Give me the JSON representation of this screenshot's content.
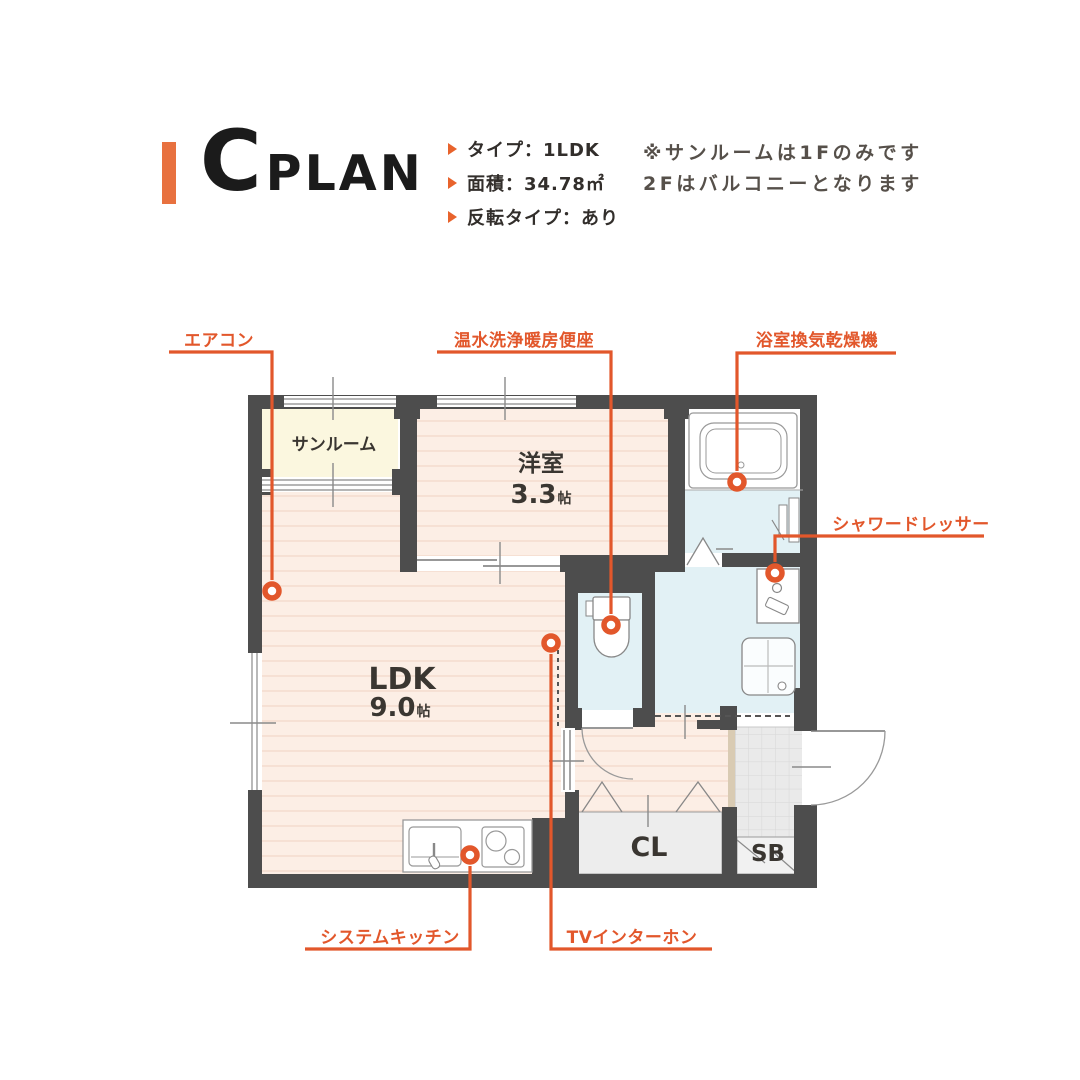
{
  "header": {
    "plan_letter": "C",
    "plan_word": "PLAN",
    "specs": [
      {
        "label": "タイプ：1LDK"
      },
      {
        "label": "面積：34.78㎡"
      },
      {
        "label": "反転タイプ：あり"
      }
    ],
    "note": {
      "line1": "※サンルームは1Fのみです",
      "line2": "2Fはバルコニーとなります"
    }
  },
  "plan": {
    "rooms": {
      "sunroom": "サンルーム",
      "western_room": {
        "name": "洋室",
        "size": "3.3",
        "unit": "帖"
      },
      "ldk": {
        "name": "LDK",
        "size": "9.0",
        "unit": "帖"
      },
      "closet": "CL",
      "shoe_box": "SB"
    },
    "callouts": {
      "air_conditioner": "エアコン",
      "washlet": "温水洗浄暖房便座",
      "bathroom_dryer": "浴室換気乾燥機",
      "shower_dresser": "シャワードレッサー",
      "system_kitchen": "システムキッチン",
      "tv_intercom": "TVインターホン"
    }
  },
  "colors": {
    "accent_orange": "#E2572B",
    "accent_bar": "#E8713F",
    "wall": "#4D4D4D",
    "ldk_floor": "#FCEEE5",
    "ldk_stripe": "#F4DCCF",
    "sunroom_floor": "#FBF7DF",
    "wet_area_floor": "#E2F1F5",
    "entrance_tile": "#EAEAEA",
    "closet_floor": "#EDEDED",
    "threshold": "#D9CBB3"
  }
}
